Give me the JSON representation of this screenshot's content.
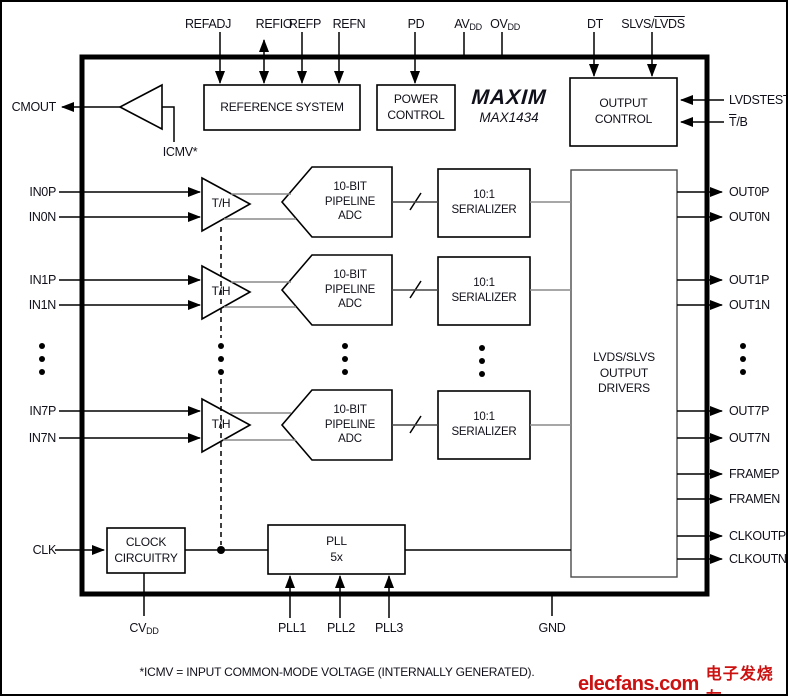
{
  "device": {
    "brand": "MAXIM",
    "part": "MAX1434"
  },
  "pins": {
    "top": {
      "refadj": "REFADJ",
      "refio": "REFIO",
      "refp": "REFP",
      "refn": "REFN",
      "pd": "PD",
      "avdd": {
        "base": "AV",
        "sub": "DD"
      },
      "ovdd": {
        "base": "OV",
        "sub": "DD"
      },
      "dt": "DT",
      "slvs_lvds": {
        "plain": "SLVS/",
        "overline": "LVDS"
      }
    },
    "left": {
      "cmout": "CMOUT",
      "in0p": "IN0P",
      "in0n": "IN0N",
      "in1p": "IN1P",
      "in1n": "IN1N",
      "in7p": "IN7P",
      "in7n": "IN7N",
      "clk": "CLK"
    },
    "right": {
      "lvdstest": "LVDSTEST",
      "tb": {
        "overline": "T",
        "plain": "/B"
      },
      "out0p": "OUT0P",
      "out0n": "OUT0N",
      "out1p": "OUT1P",
      "out1n": "OUT1N",
      "out7p": "OUT7P",
      "out7n": "OUT7N",
      "framep": "FRAMEP",
      "framen": "FRAMEN",
      "clkoutp": "CLKOUTP",
      "clkoutn": "CLKOUTN"
    },
    "bottom": {
      "cvdd": {
        "base": "CV",
        "sub": "DD"
      },
      "pll1": "PLL1",
      "pll2": "PLL2",
      "pll3": "PLL3",
      "gnd": "GND"
    }
  },
  "blocks": {
    "reference_system": "REFERENCE SYSTEM",
    "power_control": [
      "POWER",
      "CONTROL"
    ],
    "output_control": [
      "OUTPUT",
      "CONTROL"
    ],
    "th": "T/H",
    "adc": [
      "10-BIT",
      "PIPELINE",
      "ADC"
    ],
    "serializer": [
      "10:1",
      "SERIALIZER"
    ],
    "drivers": [
      "LVDS/SLVS",
      "OUTPUT",
      "DRIVERS"
    ],
    "clock": [
      "CLOCK",
      "CIRCUITRY"
    ],
    "pll": [
      "PLL",
      "5x"
    ]
  },
  "labels": {
    "icmv": "ICMV*",
    "footnote": "*ICMV = INPUT COMMON-MODE VOLTAGE (INTERNALLY GENERATED)."
  },
  "watermark": {
    "site": "elecfans.com",
    "cjk": "电子发烧友"
  },
  "colors": {
    "line": "#000000",
    "gray_line": "#8a8a8a",
    "bus_line": "#444444",
    "text": "#10101a",
    "watermark_red": "#cc1111"
  }
}
